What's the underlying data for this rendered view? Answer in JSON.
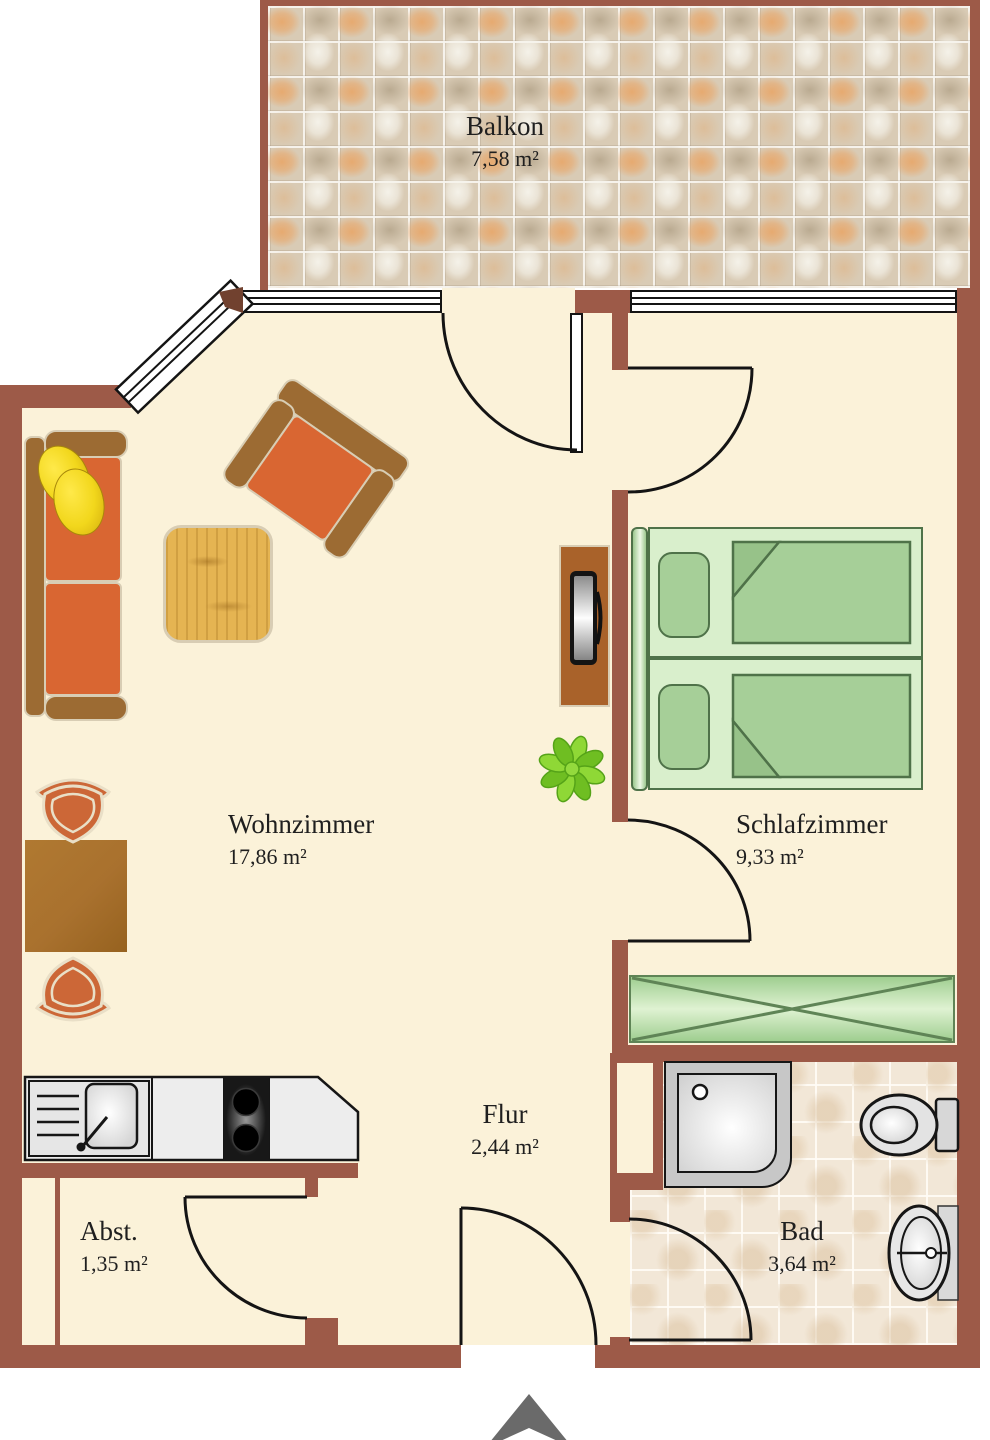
{
  "rooms": {
    "balkon": {
      "name": "Balkon",
      "area": "7,58 m²"
    },
    "wohnzimmer": {
      "name": "Wohnzimmer",
      "area": "17,86 m²"
    },
    "schlafzimmer": {
      "name": "Schlafzimmer",
      "area": "9,33 m²"
    },
    "flur": {
      "name": "Flur",
      "area": "2,44 m²"
    },
    "abstellraum": {
      "name": "Abst.",
      "area": "1,35 m²"
    },
    "bad": {
      "name": "Bad",
      "area": "3,64 m²"
    }
  },
  "icons": {
    "entrance_marker": "up-arrow"
  },
  "colors": {
    "wall": "#9d5a48",
    "wall_dark_wedge": "#71412f",
    "floor": "#fbf2d9",
    "outline_dark": "#141414",
    "sofa_orange": "#d96632",
    "furniture_frame": "#9c6b33",
    "furniture_outline": "#d8cdb4",
    "pillow_yellow": "#f2d71c",
    "wood": "#e5b452",
    "table_brown": "#a9712e",
    "tv_board": "#a9622a",
    "bed_base": "#d9efcc",
    "bed_soft": "#a6cf98",
    "bed_border": "#4f7249",
    "wardrobe_border": "#5f8456",
    "chair_orange": "#cc6737",
    "chair_outline": "#e9dfc7",
    "plant_green": "#7ccb28",
    "plant_dark": "#55a318",
    "counter": "#ededed",
    "stove": "#181818",
    "fixture_gray": "#e3e3e3",
    "tile_balcony_base": "#d9cbb5",
    "tile_bath": "#f2e7d7",
    "arrow": "#6a6a6a",
    "label": "#1f1f1f"
  }
}
